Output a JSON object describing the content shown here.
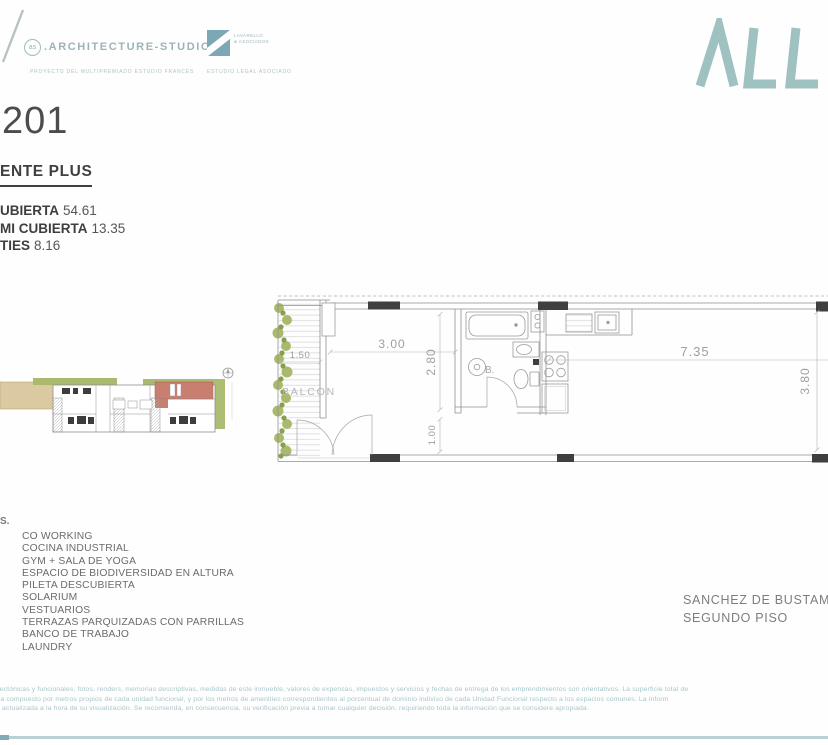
{
  "header": {
    "arch_logo": {
      "badge": "as",
      "name": ".ARCHITECTURE-STUDIO",
      "subtitle": "PROYECTO DEL MULTIPREMIADO ESTUDIO FRANCÉS"
    },
    "legal_logo": {
      "line1": "LAVARELLO",
      "line2": "& ASOCIADOS",
      "subtitle": "ESTUDIO LEGAL ASOCIADO"
    },
    "brand_text": "ΛLL"
  },
  "unit": {
    "number": "201",
    "type_fragment": "ENTE PLUS",
    "areas": [
      {
        "label": "UBIERTA",
        "value": "54.61"
      },
      {
        "label": "MI CUBIERTA",
        "value": "13.35"
      },
      {
        "label": "TIES",
        "value": "8.16"
      }
    ]
  },
  "floorplan": {
    "labels": {
      "balcony": "BALCON",
      "bath": "B."
    },
    "dims": {
      "balcony_width": "1.50",
      "room_width": "3.00",
      "room_depth": "2.80",
      "passage": "1.00",
      "living_width": "7.35",
      "living_depth": "3.80"
    }
  },
  "amenities": {
    "heading_fragment": "S.",
    "items": [
      "CO WORKING",
      "COCINA INDUSTRIAL",
      "GYM + SALA DE YOGA",
      "ESPACIO DE BIODIVERSIDAD EN ALTURA",
      "PILETA DESCUBIERTA",
      "SOLARIUM",
      "VESTUARIOS",
      "TERRAZAS PARQUIZADAS CON PARRILLAS",
      "BANCO DE TRABAJO",
      "LAUNDRY"
    ]
  },
  "location": {
    "line1": "SANCHEZ DE BUSTAMANTE",
    "line2": "SEGUNDO PISO"
  },
  "disclaimer": {
    "lines": [
      "itectónicas y funcionales, fotos, renders, memorias descriptivas, medidas de este inmueble, valores de expensas, impuestos y servicios y fechas de entrega de los emprendimientos son orientativos. La superficie total de",
      "tra compuesto por metros propios de cada unidad funcional, y por los metros de amenities correspondientes al porcentual de dominio indiviso de cada Unidad Funcional respecto a los espacios comunes. La inform",
      "e actualizada a la hora de su visualización. Se recomienda, en consecuencia, su verificación previa a tomar cualquier decisión, requiriendo toda la información que se considere apropiada."
    ]
  },
  "colors": {
    "brand_teal": "#9fc2c1",
    "logo_teal": "#9cb4b8",
    "unit_highlight_red": "#c97f6f",
    "keyplan_tan": "#dbc9a2",
    "keyplan_green": "#a9ba6e",
    "plan_line_gray": "#8f8f8f",
    "disclaimer_teal": "#a8c6ca",
    "rule_teal": "#b9d1d5"
  }
}
